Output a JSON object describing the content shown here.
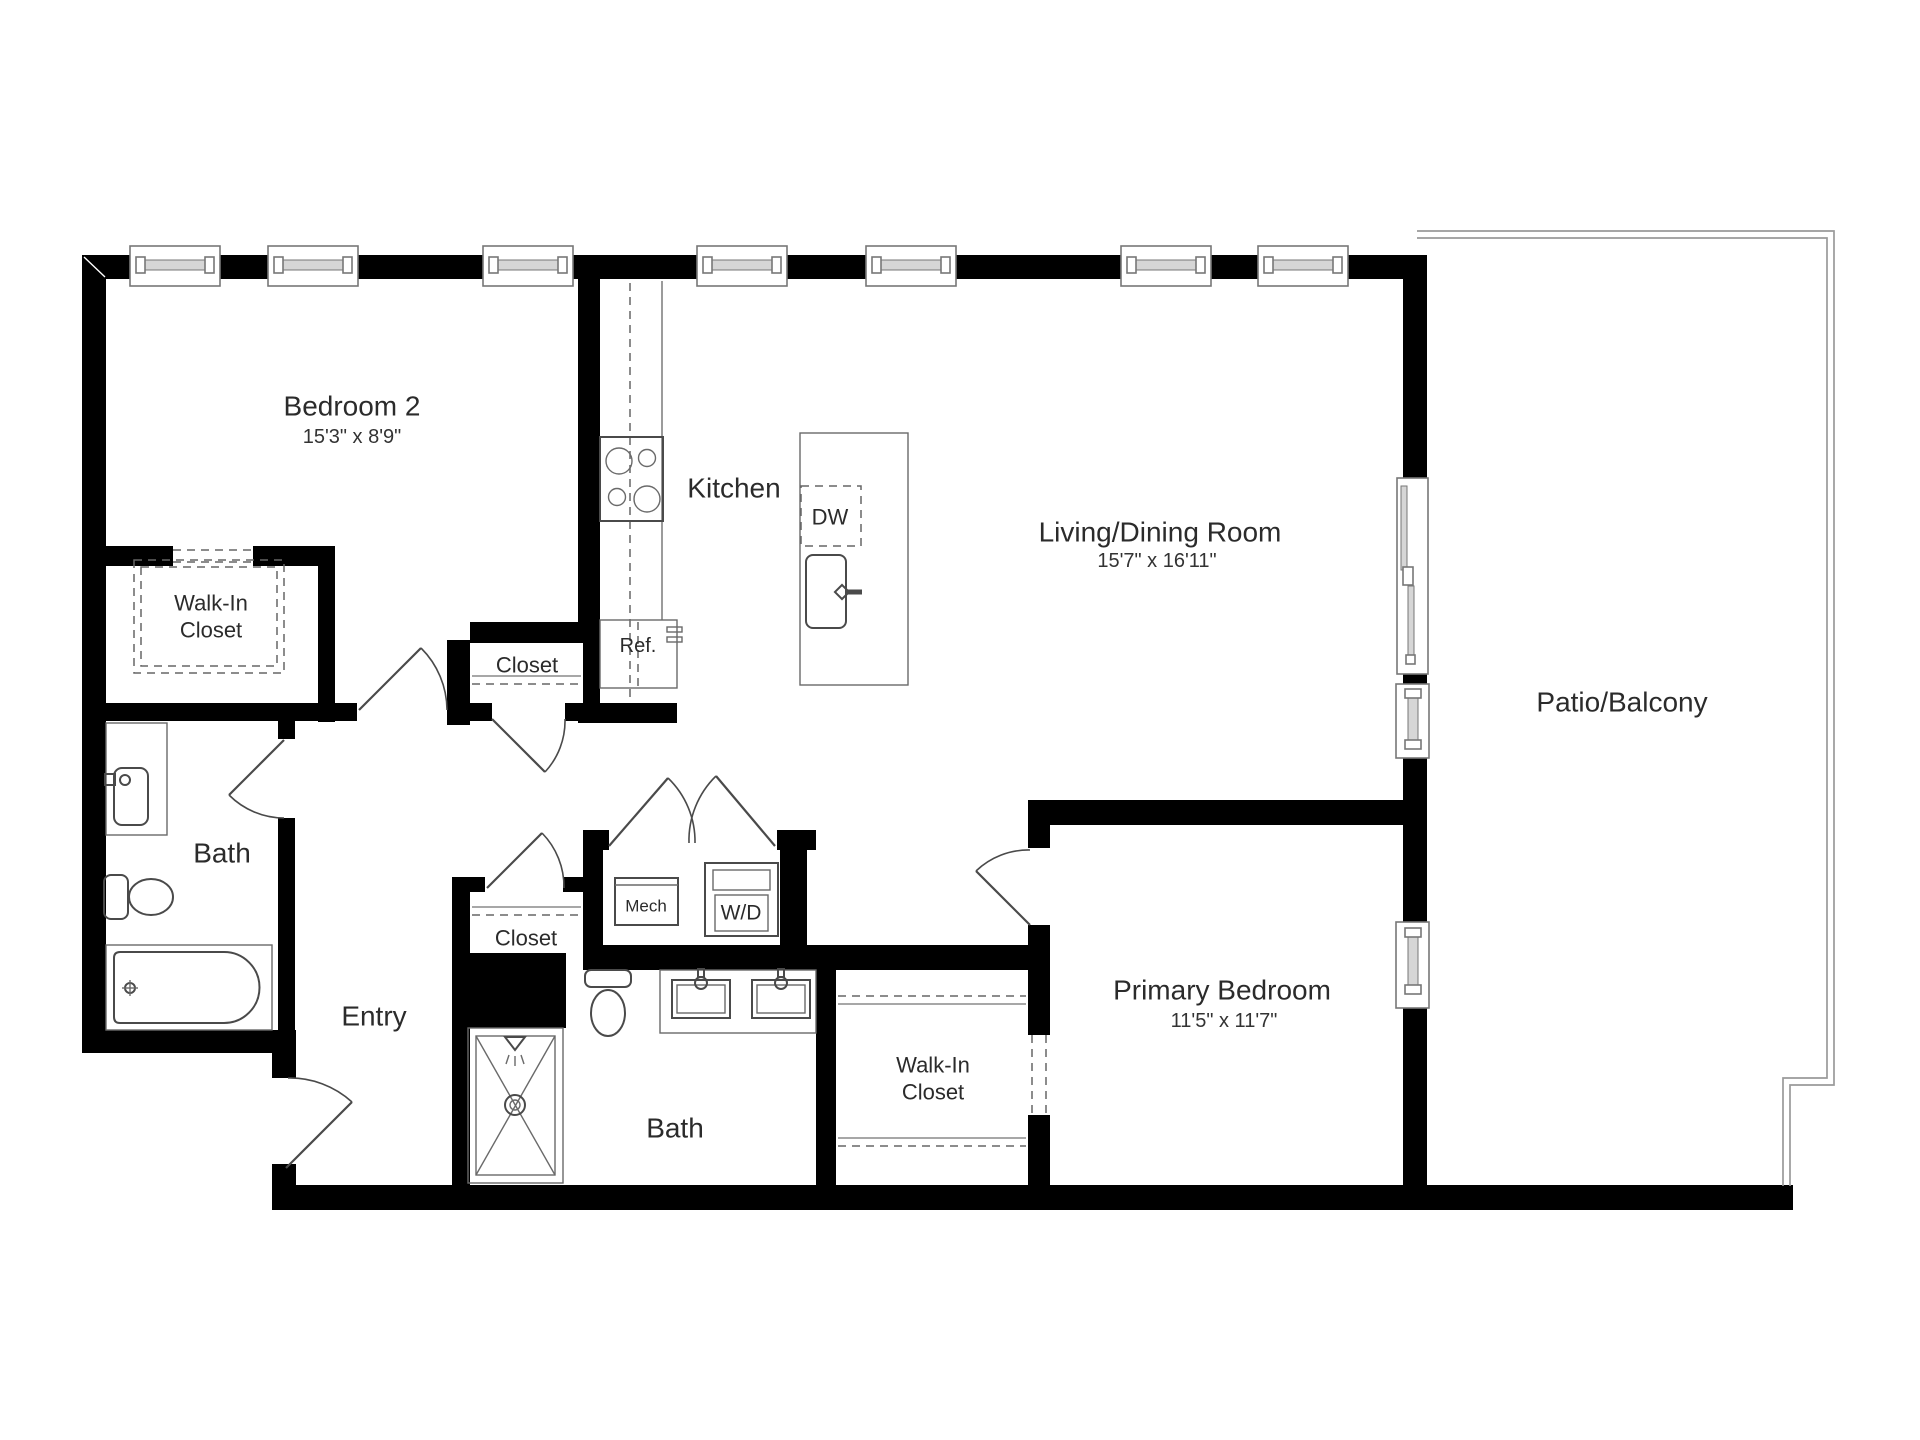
{
  "floorplan": {
    "rooms": {
      "bedroom2": {
        "name": "Bedroom 2",
        "dims": "15'3\" x 8'9\""
      },
      "kitchen": {
        "name": "Kitchen"
      },
      "living_dining": {
        "name": "Living/Dining Room",
        "dims": "15'7\" x 16'11\""
      },
      "patio": {
        "name": "Patio/Balcony"
      },
      "walk_in_closet_bedroom2": {
        "line1": "Walk-In",
        "line2": "Closet"
      },
      "bath1": {
        "name": "Bath"
      },
      "entry": {
        "name": "Entry"
      },
      "closet_upper": {
        "name": "Closet"
      },
      "closet_lower": {
        "name": "Closet"
      },
      "bath2": {
        "name": "Bath"
      },
      "walk_in_closet_primary": {
        "line1": "Walk-In",
        "line2": "Closet"
      },
      "primary_bedroom": {
        "name": "Primary Bedroom",
        "dims": "11'5\" x 11'7\""
      }
    },
    "fixtures": {
      "refrigerator": "Ref.",
      "dishwasher": "DW",
      "mechanical": "Mech",
      "washer_dryer": "W/D"
    },
    "colors": {
      "walls": "#000000",
      "fixture_lines": "#4a4a4a",
      "text": "#2b2b2b",
      "patio_outline": "#9a9a9a"
    }
  }
}
